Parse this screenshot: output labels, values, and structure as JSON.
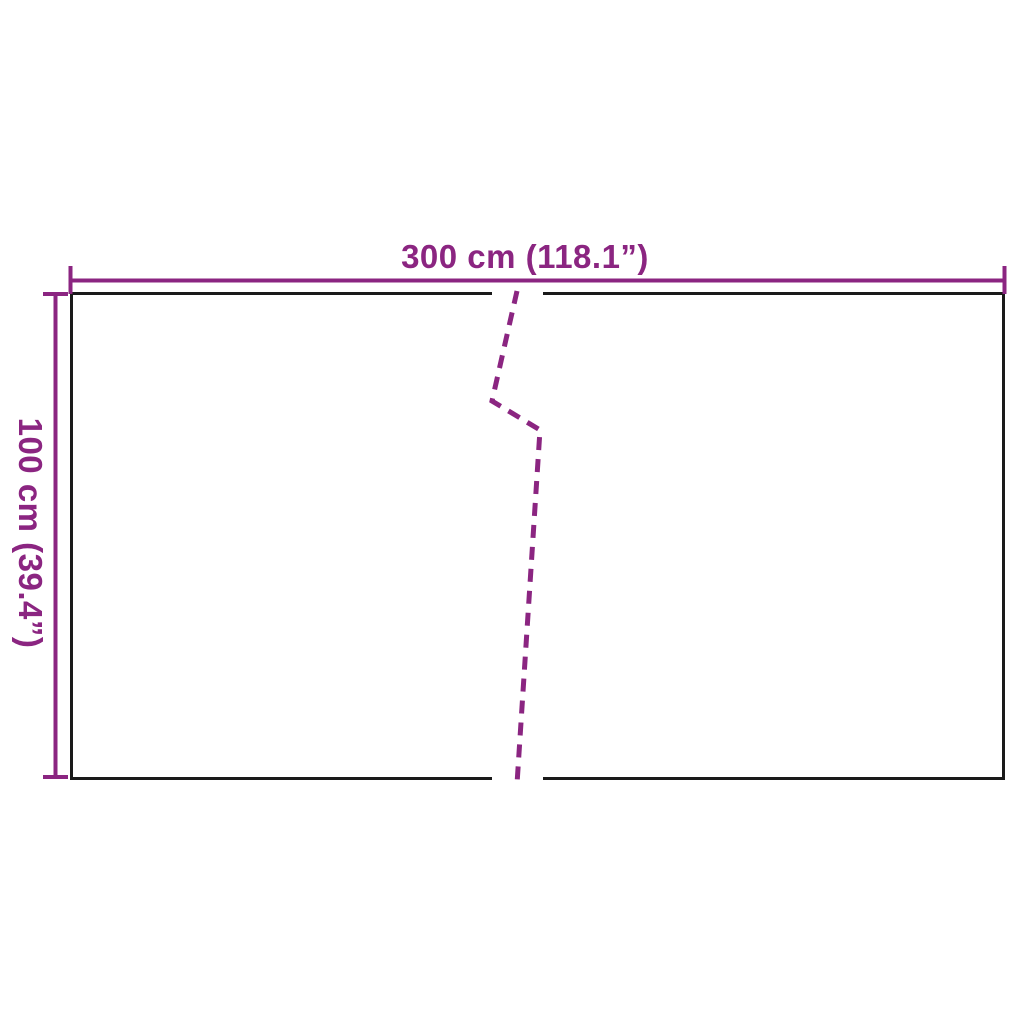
{
  "diagram": {
    "width_label": "300 cm (118.1”)",
    "height_label": "100 cm (39.4”)",
    "colors": {
      "accent": "#8b2581",
      "line": "#1a1a1a",
      "background": "#ffffff"
    }
  }
}
